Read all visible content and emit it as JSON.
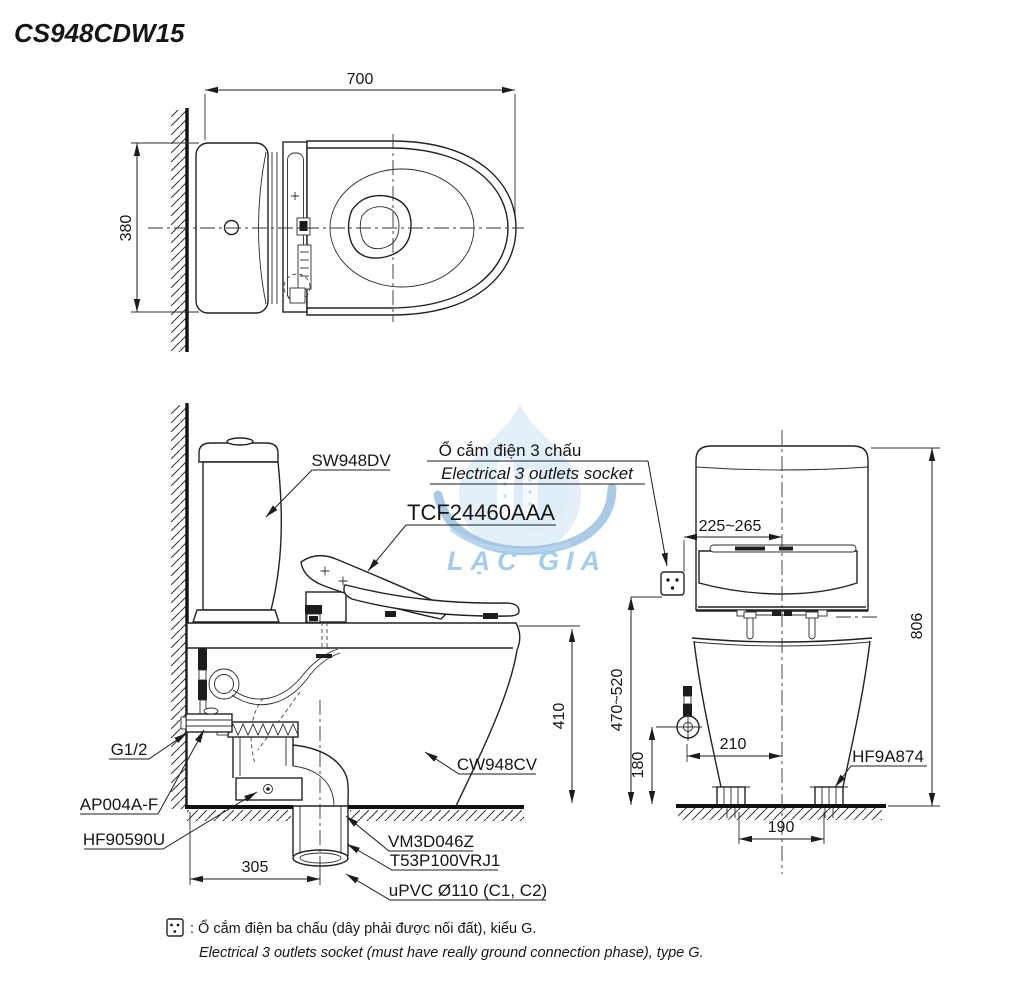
{
  "page": {
    "title": "CS948CDW15"
  },
  "watermark": {
    "text": "LẠC GIA",
    "blue": "#4d9bd5",
    "light_blue": "#c9e2f5",
    "swoosh_blue": "#2f7dbf"
  },
  "colors": {
    "line": "#1f1f1f",
    "background": "#ffffff"
  },
  "top_view": {
    "dim_width": "700",
    "dim_depth": "380"
  },
  "side_view": {
    "label_tank": "SW948DV",
    "label_washlet": "TCF24460AAA",
    "label_socket_vi": "Ổ cắm điện 3 chấu",
    "label_socket_en": "Electrical 3 outlets socket",
    "label_bowl": "CW948CV",
    "label_supply": "G1/2",
    "label_valve": "AP004A-F",
    "label_flange": "HF90590U",
    "label_outlet": "VM3D046Z",
    "label_joint": "T53P100VRJ1",
    "label_pipe": "uPVC Ø110 (C1, C2)",
    "dim_height": "410",
    "dim_outlet": "305"
  },
  "rear_view": {
    "label_bolt": "HF9A874",
    "dim_socket_offset": "225~265",
    "dim_total_height": "806",
    "dim_socket_height": "470~520",
    "dim_valve_height": "180",
    "dim_valve_offset": "210",
    "dim_bolt_span": "190"
  },
  "footnote": {
    "vi": ": Ổ cắm điện ba chấu (dây phải được nối đất), kiểu G.",
    "en": "Electrical 3 outlets socket (must have really ground connection phase), type G."
  }
}
